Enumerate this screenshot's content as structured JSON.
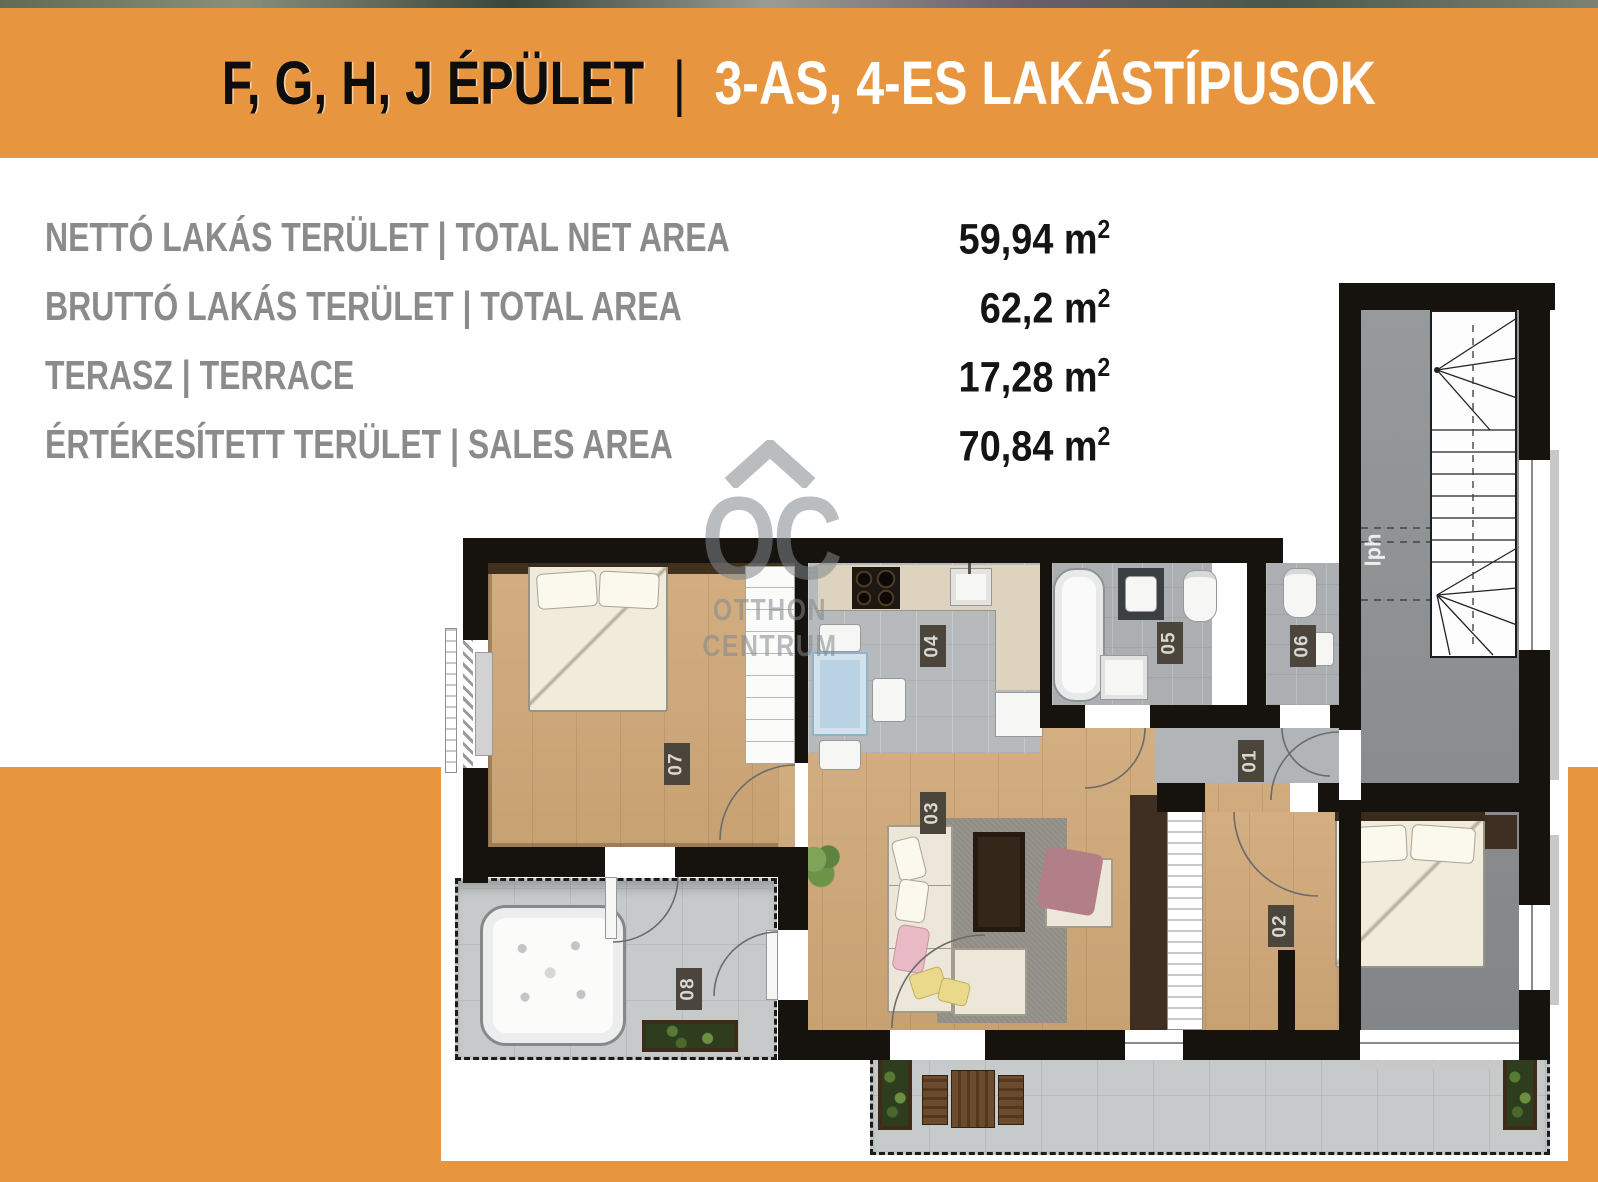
{
  "banner": {
    "part1": "F, G, H, J ÉPÜLET",
    "separator": "|",
    "part2": "3-AS, 4-ES LAKÁSTÍPUSOK",
    "bg_color": "#E8953F",
    "part1_color": "#0d0d0d",
    "part2_color": "#ffffff"
  },
  "stats": {
    "unit": "m",
    "sup": "2",
    "label_color": "#8b8b8b",
    "value_color": "#141414",
    "rows": [
      {
        "label": "NETTÓ LAKÁS TERÜLET |  TOTAL NET AREA",
        "value": "59,94 "
      },
      {
        "label": "BRUTTÓ LAKÁS TERÜLET |  TOTAL AREA",
        "value": "62,2 "
      },
      {
        "label": "TERASZ |  TERRACE",
        "value": "17,28 "
      },
      {
        "label": "ÉRTÉKESÍTETT TERÜLET |  SALES AREA",
        "value": "70,84 "
      }
    ]
  },
  "plan": {
    "rooms": {
      "r01": "01",
      "r02": "02",
      "r03": "03",
      "r04": "04",
      "r05": "05",
      "r06": "06",
      "r07": "07",
      "r08": "08"
    },
    "stair_label": "lph",
    "watermark": {
      "oc": "OC",
      "line1": "OTTHON",
      "line2": "CENTRUM"
    },
    "wall_color": "#16120e",
    "wood_color": "#cda87c",
    "tile_color": "#b7babc",
    "label_box_color": "#4b453c"
  }
}
